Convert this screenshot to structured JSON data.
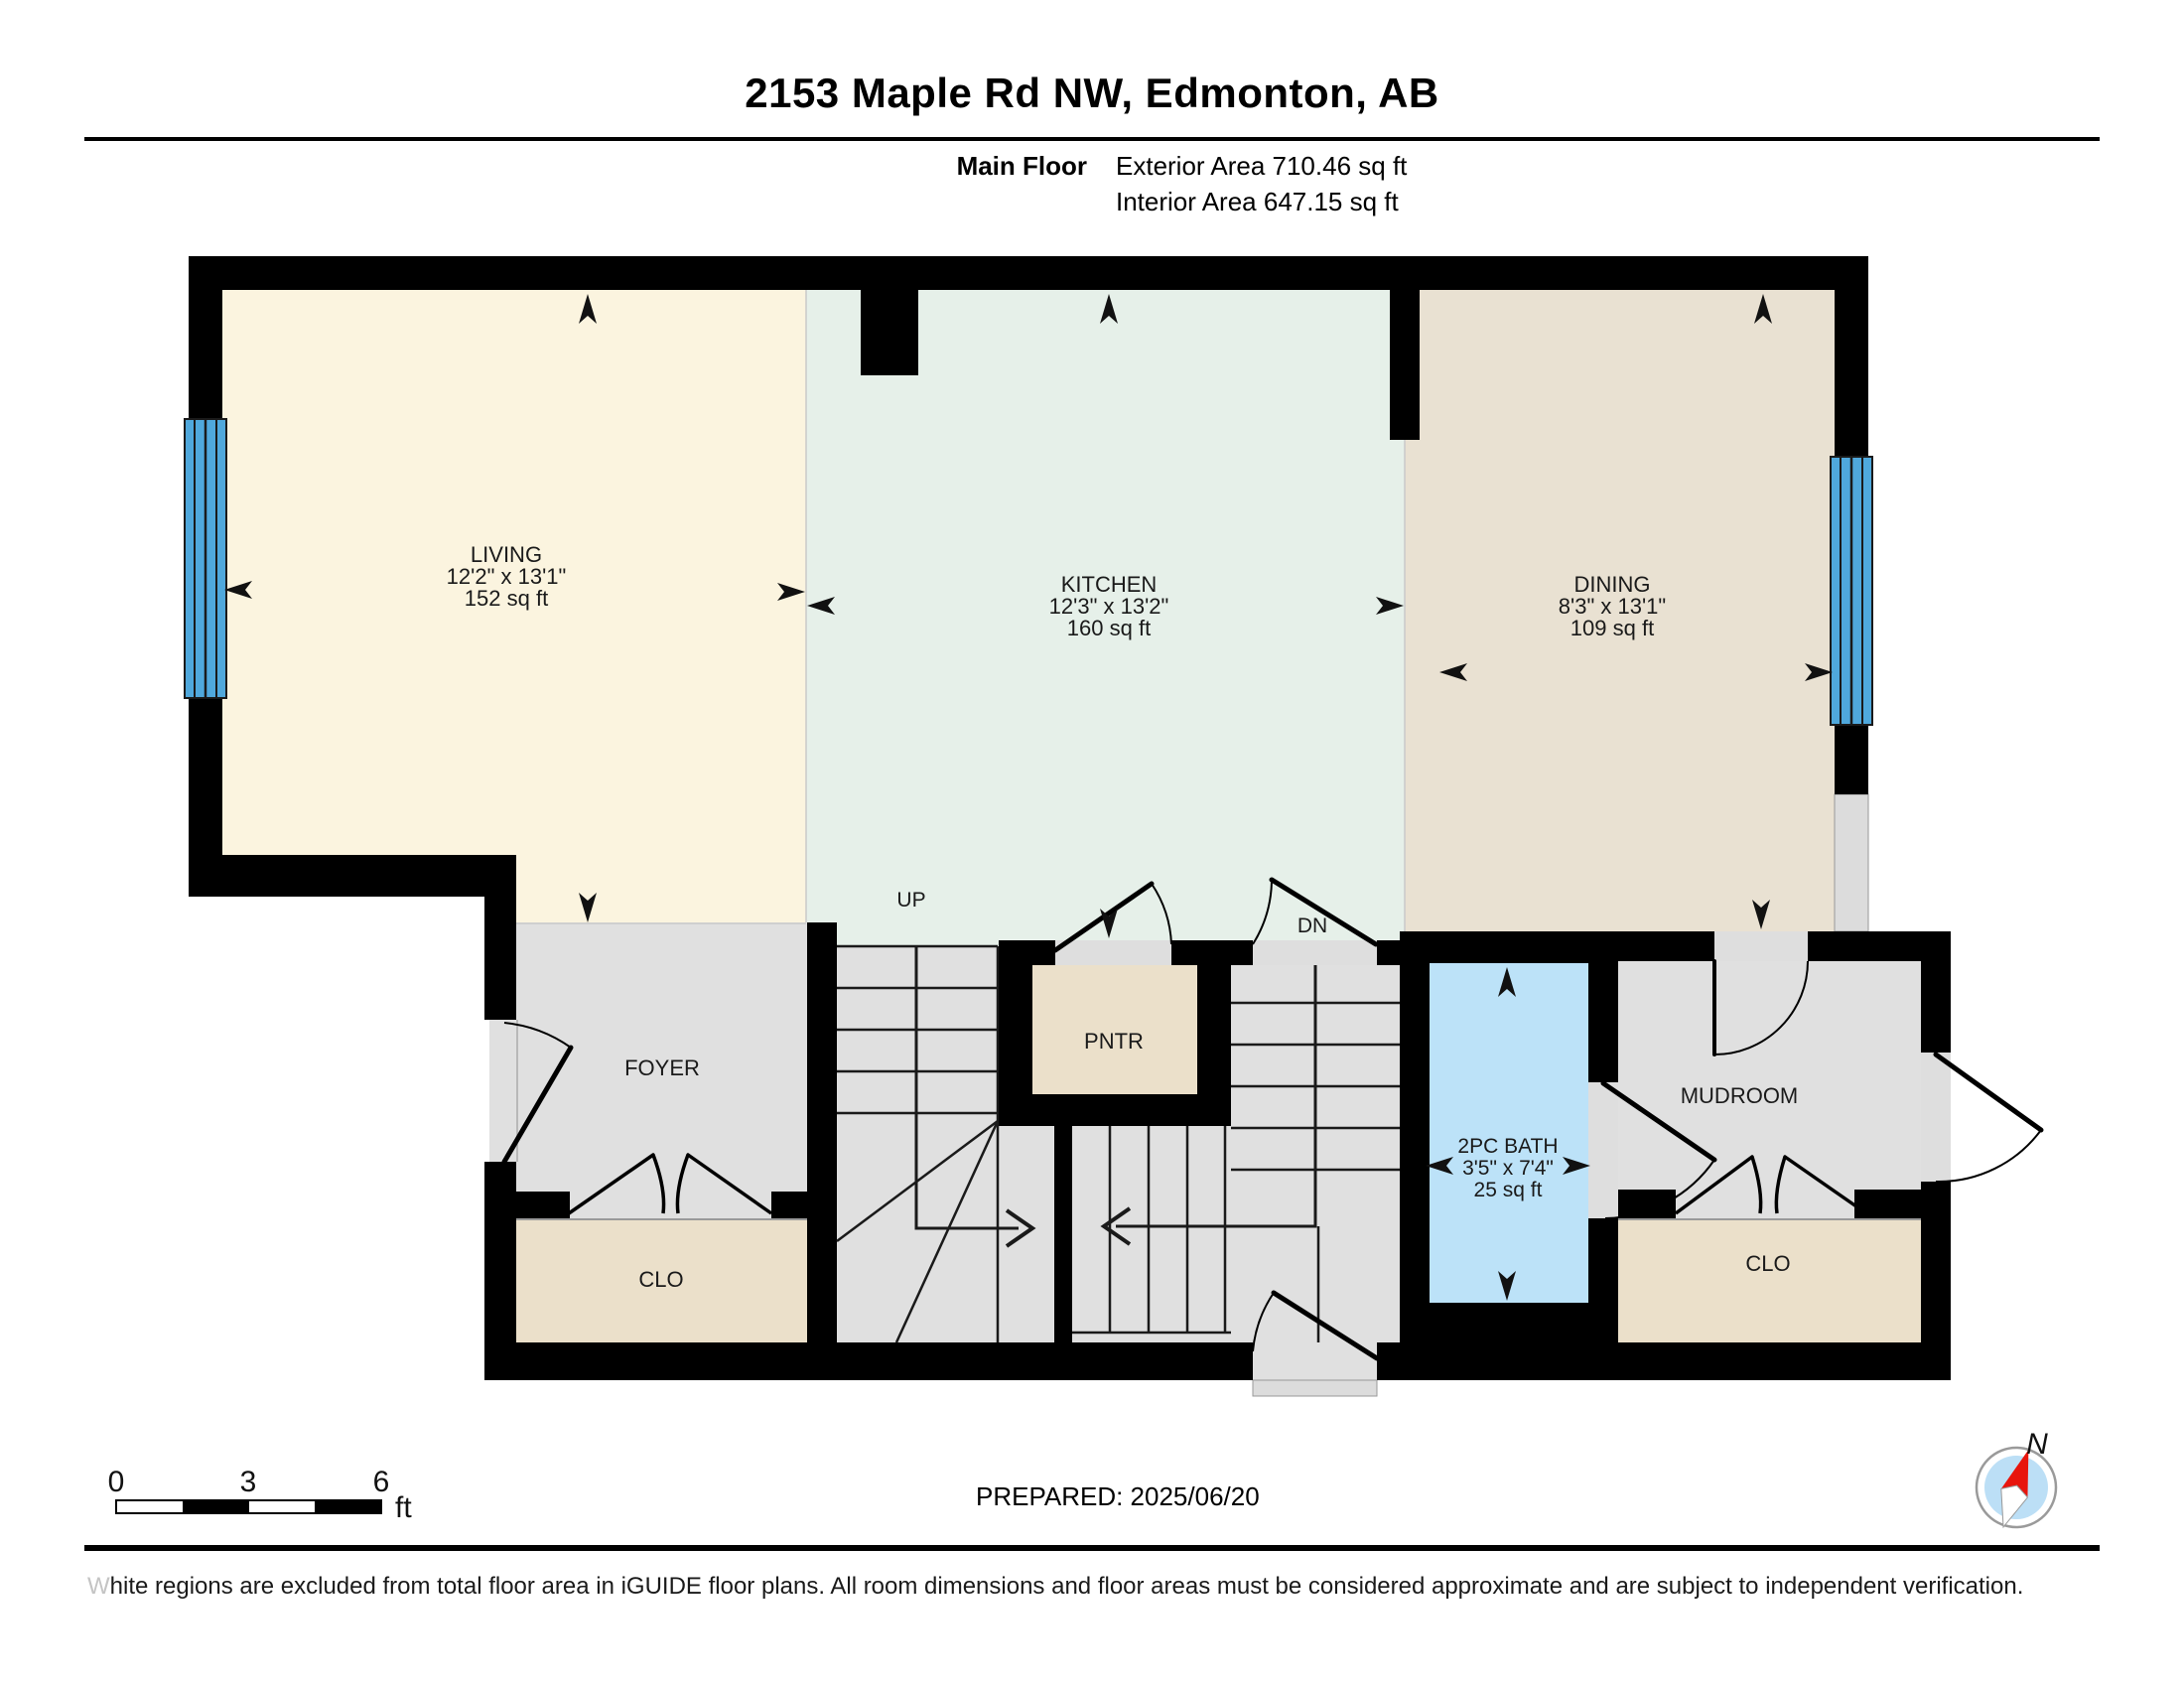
{
  "header": {
    "title": "2153 Maple Rd NW, Edmonton, AB",
    "floor_label": "Main Floor",
    "exterior_area": "Exterior Area 710.46 sq ft",
    "interior_area": "Interior Area 647.15 sq ft"
  },
  "rooms": {
    "living": {
      "name": "LIVING",
      "dims": "12'2\" x 13'1\"",
      "area": "152 sq ft"
    },
    "kitchen": {
      "name": "KITCHEN",
      "dims": "12'3\" x 13'2\"",
      "area": "160 sq ft"
    },
    "dining": {
      "name": "DINING",
      "dims": "8'3\" x 13'1\"",
      "area": "109 sq ft"
    },
    "bath": {
      "name": "2PC BATH",
      "dims": "3'5\" x 7'4\"",
      "area": "25 sq ft"
    },
    "foyer": {
      "name": "FOYER"
    },
    "pantry": {
      "name": "PNTR"
    },
    "mudroom": {
      "name": "MUDROOM"
    },
    "closet_left": {
      "name": "CLO"
    },
    "closet_right": {
      "name": "CLO"
    }
  },
  "stairs": {
    "up_label": "UP",
    "down_label": "DN"
  },
  "scale_bar": {
    "tick_0": "0",
    "tick_3": "3",
    "tick_6": "6",
    "unit": "ft"
  },
  "compass": {
    "north_label": "N"
  },
  "footer": {
    "prepared": "PREPARED: 2025/06/20",
    "disclaimer_first_letter": "W",
    "disclaimer_rest": "hite regions are excluded from total floor area in iGUIDE floor plans. All room dimensions and floor areas must be considered approximate and are subject to independent verification."
  },
  "colors": {
    "wall": "#000000",
    "living_floor": "#FBF4DF",
    "kitchen_floor": "#E6F0E9",
    "dining_floor": "#E9E1D2",
    "closet_floor": "#EBE0CA",
    "hall_floor": "#E0E0E0",
    "threshold_gray": "#DEDEDE",
    "excluded_gray": "#DCDCDC",
    "bath_floor": "#BCE2F8",
    "window_blue": "#4FA8DC",
    "compass_inner": "#BCDFF6",
    "compass_needle_red": "#E8150D"
  }
}
